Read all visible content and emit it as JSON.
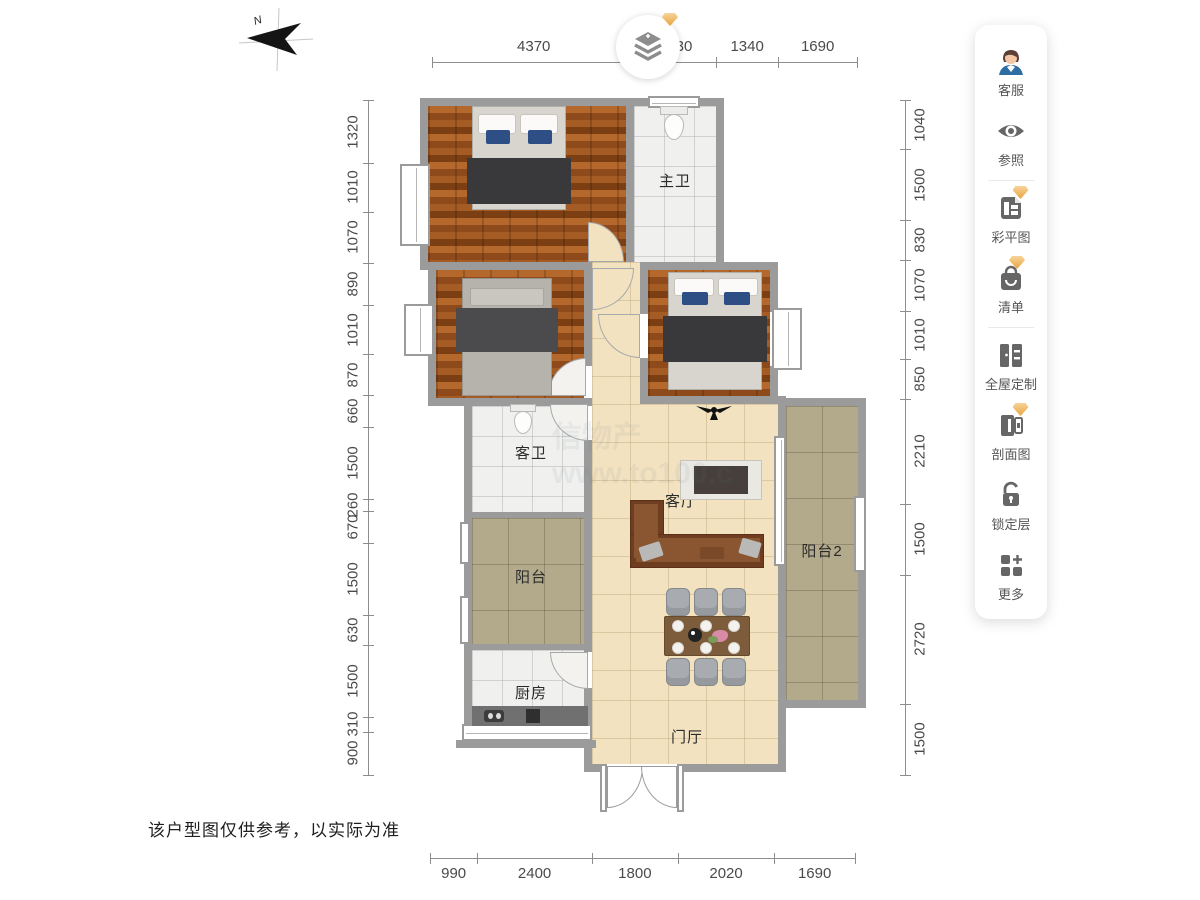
{
  "compass": {
    "label": "N"
  },
  "logo": {
    "icon": "layers-plus-icon"
  },
  "toolbar": {
    "items": [
      {
        "label": "客服",
        "icon": "customer-service-avatar-icon",
        "premium": false
      },
      {
        "label": "参照",
        "icon": "eye-icon",
        "premium": false
      },
      {
        "label": "彩平图",
        "icon": "color-plan-icon",
        "premium": true
      },
      {
        "label": "清单",
        "icon": "shopping-bag-icon",
        "premium": true
      },
      {
        "label": "全屋定制",
        "icon": "wardrobe-icon",
        "premium": false
      },
      {
        "label": "剖面图",
        "icon": "section-view-icon",
        "premium": true
      },
      {
        "label": "锁定层",
        "icon": "unlock-icon",
        "premium": false
      },
      {
        "label": "更多",
        "icon": "more-grid-icon",
        "premium": false
      }
    ]
  },
  "rooms": {
    "master_bath": "主卫",
    "guest_bath": "客卫",
    "living_room": "客厅",
    "balcony": "阳台",
    "balcony2": "阳台2",
    "kitchen": "厨房",
    "foyer": "门厅"
  },
  "rulers": {
    "top": [
      4370,
      1730,
      1340,
      1690
    ],
    "bottom": [
      990,
      2400,
      1800,
      2020,
      1690
    ],
    "left": [
      1320,
      1010,
      1070,
      890,
      1010,
      870,
      660,
      1500,
      260,
      670,
      1500,
      630,
      1500,
      310,
      900
    ],
    "right": [
      1040,
      1500,
      830,
      1070,
      1010,
      850,
      2210,
      1500,
      2720,
      1500
    ]
  },
  "watermark": {
    "line1": "信物产",
    "line2": "www.to100.c"
  },
  "disclaimer": "该户型图仅供参考，以实际为准",
  "colors": {
    "wall": "#9b9b9b",
    "wood": "#a6591f",
    "tile_beige": "#f2e2c0",
    "tile_khaki": "#b3a98b",
    "tile_white": "#f0f0ee",
    "premium_gem": "#edaa4c",
    "sofa": "#7b4527"
  }
}
